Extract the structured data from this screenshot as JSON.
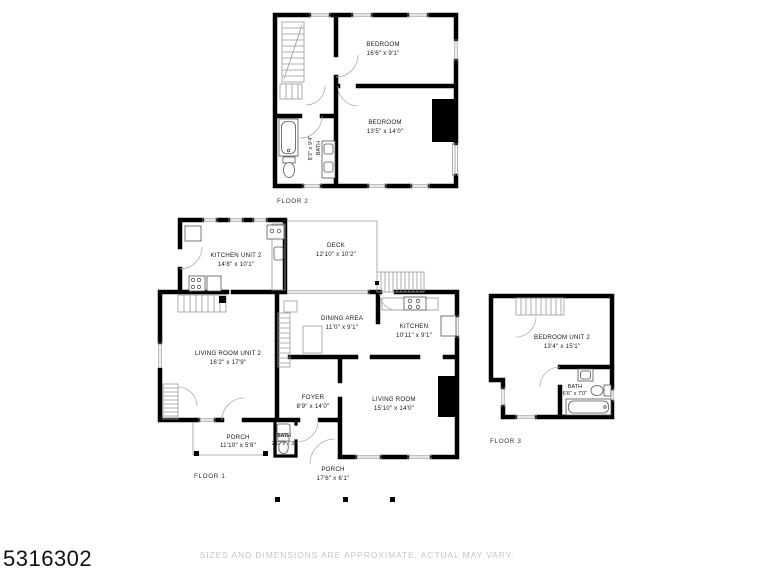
{
  "branding": {
    "id_number": "5316302"
  },
  "footer": {
    "disclaimer": "SIZES AND DIMENSIONS ARE APPROXIMATE, ACTUAL MAY VARY."
  },
  "colors": {
    "wall": "#000000",
    "line": "#999999",
    "label": "#1a1a1a",
    "muted": "#c5c5c5"
  },
  "floor2": {
    "label": "FLOOR 2",
    "bedroom1": {
      "name": "BEDROOM",
      "dims": "16'6\" x 9'1\""
    },
    "bedroom2": {
      "name": "BEDROOM",
      "dims": "13'5\" x 14'0\""
    },
    "bath": {
      "name": "BATH",
      "dims": "8'3\" x 9'4\""
    }
  },
  "floor1": {
    "label": "FLOOR 1",
    "kitchen_unit2": {
      "name": "KITCHEN UNIT 2",
      "dims": "14'8\" x 10'1\""
    },
    "deck": {
      "name": "DECK",
      "dims": "12'10\" x 10'2\""
    },
    "dining": {
      "name": "DINING AREA",
      "dims": "11'0\" x 9'1\""
    },
    "kitchen": {
      "name": "KITCHEN",
      "dims": "10'11\" x 9'1\""
    },
    "living_unit2": {
      "name": "LIVING ROOM UNIT 2",
      "dims": "16'2\" x 17'9\""
    },
    "foyer": {
      "name": "FOYER",
      "dims": "8'9\" x 14'0\""
    },
    "living": {
      "name": "LIVING ROOM",
      "dims": "15'10\" x 14'0\""
    },
    "porch1": {
      "name": "PORCH",
      "dims": "11'10\" x 5'8\""
    },
    "bath": {
      "name": "BATH",
      "dims": "2'6\" x 7'3\""
    },
    "porch2": {
      "name": "PORCH",
      "dims": "17'6\" x 6'1\""
    }
  },
  "floor3": {
    "label": "FLOOR 3",
    "bedroom_unit2": {
      "name": "BEDROOM UNIT 2",
      "dims": "13'4\" x 15'1\""
    },
    "bath": {
      "name": "BATH",
      "dims": "6'6\" x 7'0\""
    }
  }
}
